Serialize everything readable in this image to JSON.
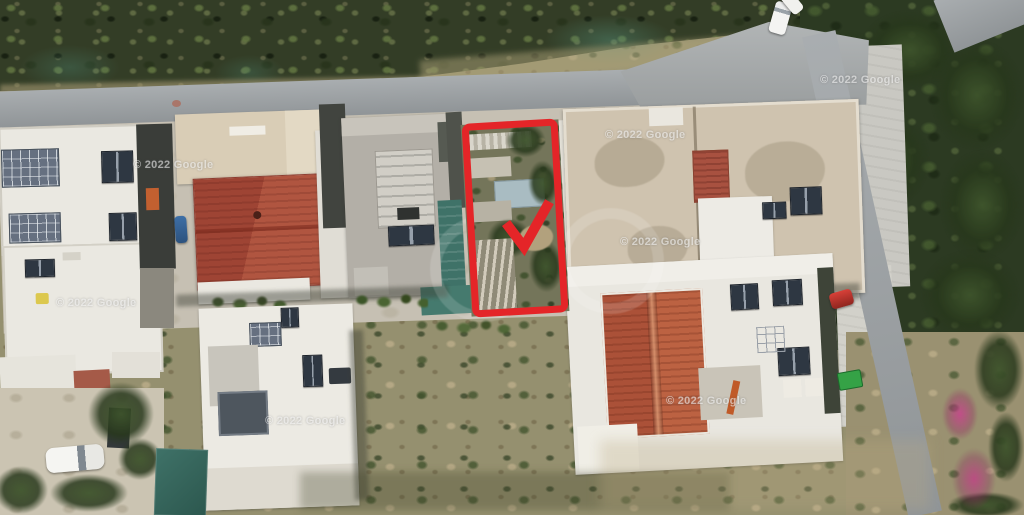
{
  "watermark": {
    "text": "© 2022 Google"
  },
  "colors": {
    "highlight-red": "#e42528",
    "vegetation-dark": "#333d26",
    "trees-dark": "#2c3a22",
    "road-gray": "#9ba0a3",
    "pavement": "#c9c8c2",
    "ground-light": "#c6c0b3",
    "building-white": "#eae8e1",
    "roof-tan": "#cfc3af",
    "roof-red": "#a5503c",
    "roof-red-bright": "#b7603f",
    "teal-structure": "#3f7268",
    "scrub-olive": "#95906f"
  }
}
